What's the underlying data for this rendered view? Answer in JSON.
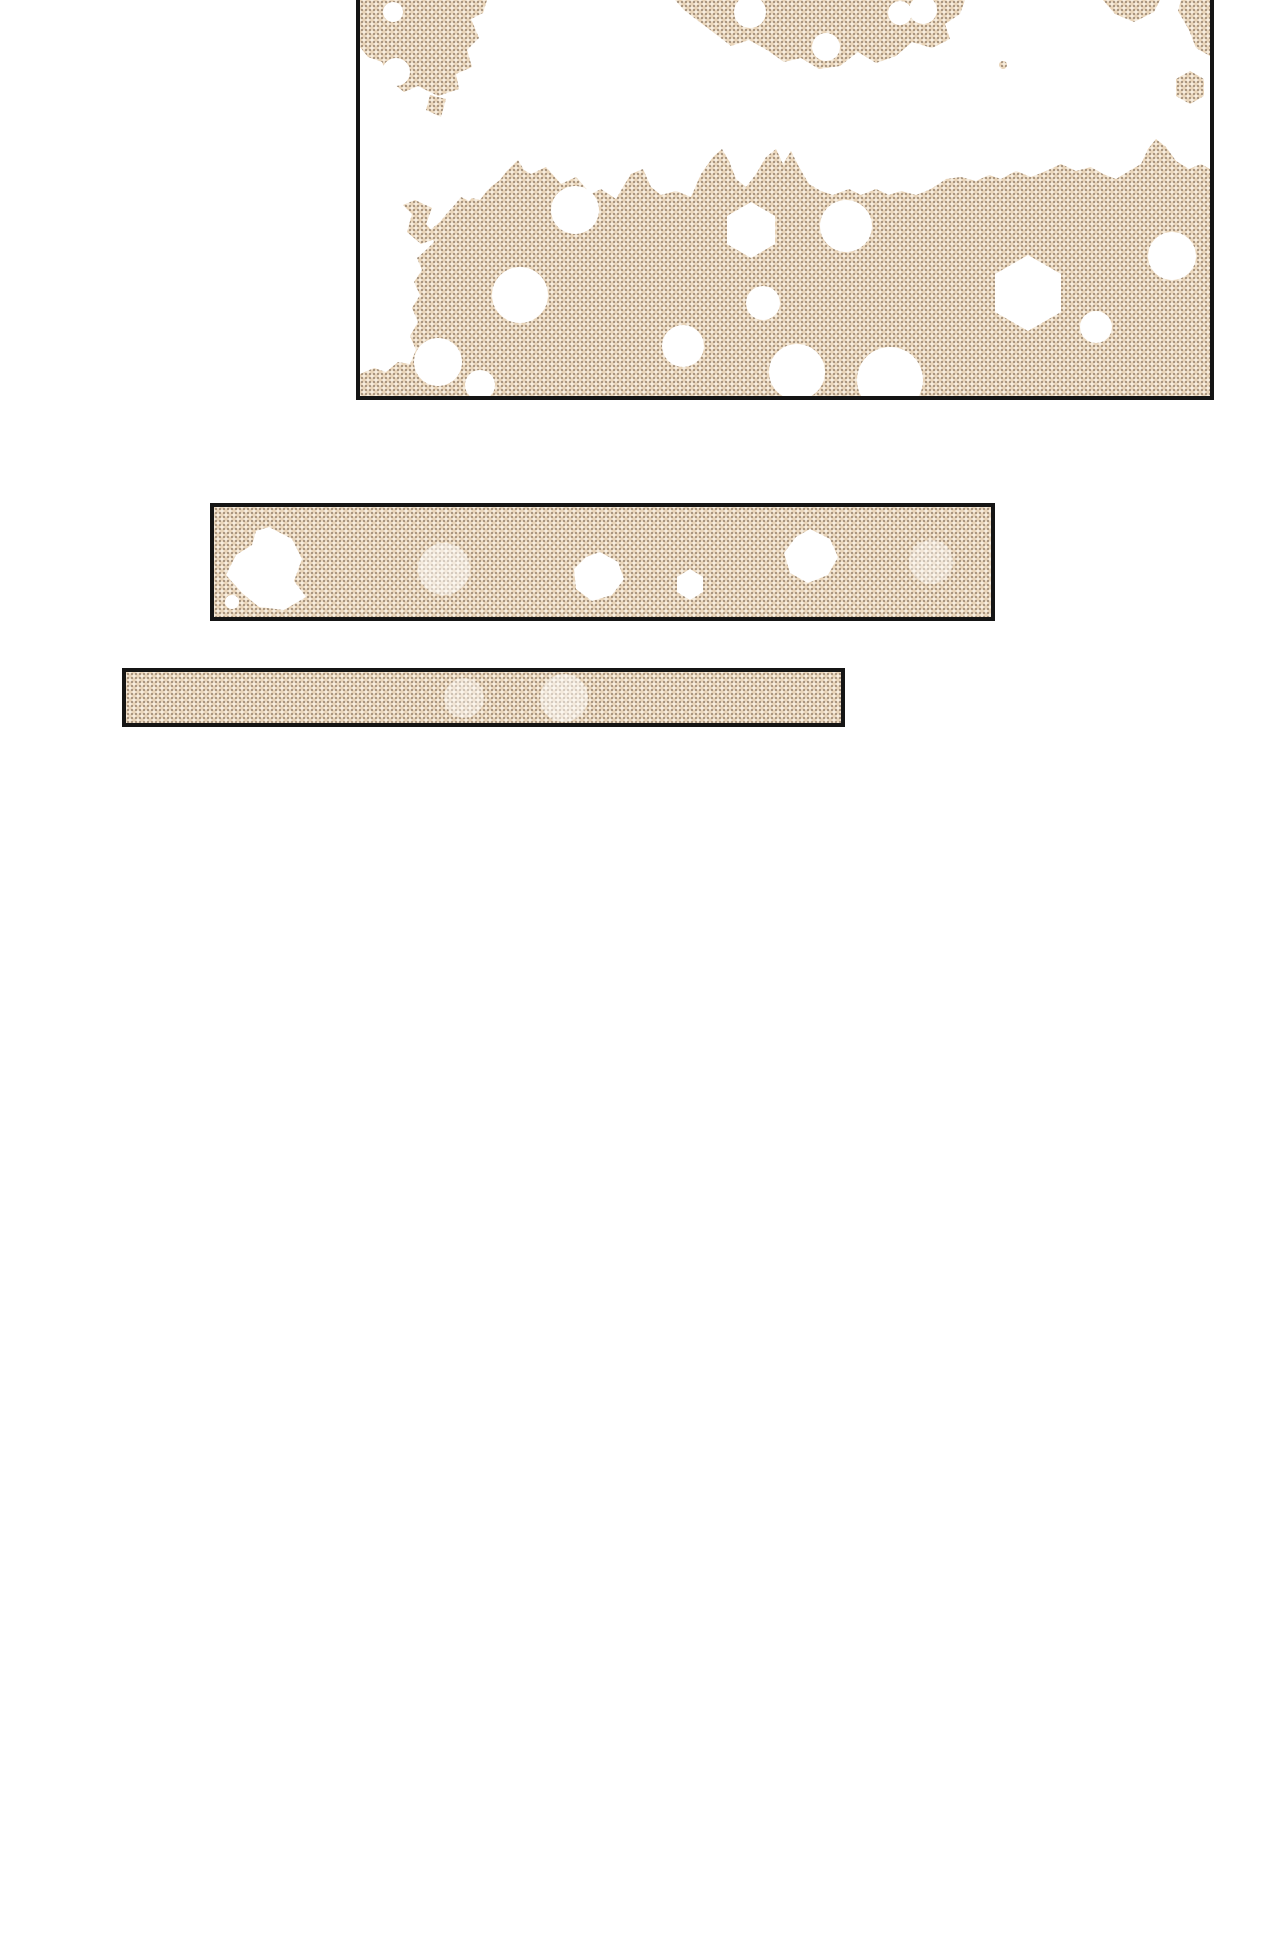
{
  "page": {
    "background_color": "#ffffff"
  },
  "panels": {
    "border_color": "#151515",
    "halftone_paper_color": "#f5ecde",
    "halftone_dot_dark_color": "#94806b",
    "halftone_dot_light_color": "#e9d5ba",
    "halftone_hole_color": "#ffffff",
    "items": [
      {
        "name": "main-art-panel"
      },
      {
        "name": "wide-strip-panel"
      },
      {
        "name": "thin-strip-panel"
      }
    ]
  }
}
